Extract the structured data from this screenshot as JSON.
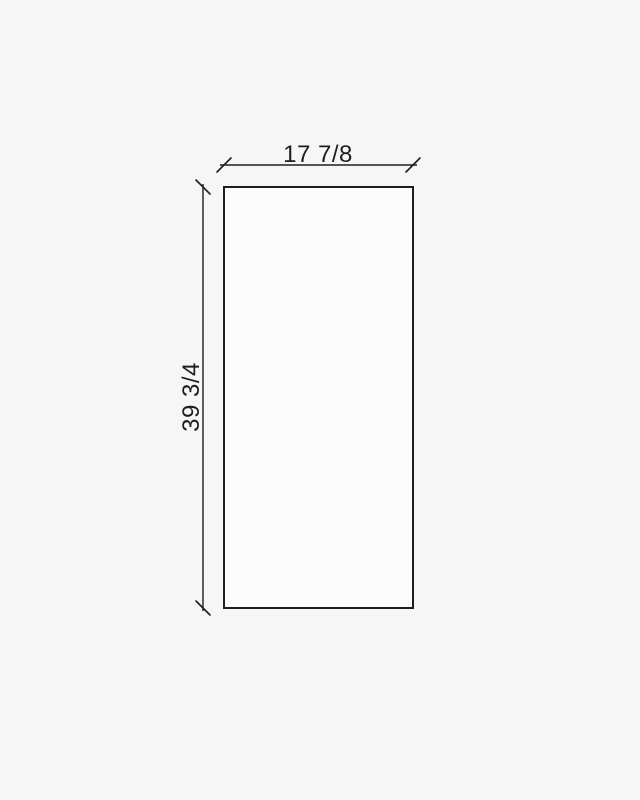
{
  "diagram": {
    "title": "panel-dimension-drawing",
    "width_label": "17 7/8",
    "height_label": "39 3/4",
    "background_color": "#f6f6f6",
    "panel_fill": "#fcfcfc",
    "line_color": "#1e1e1e",
    "text_color": "#1e1e1e"
  }
}
